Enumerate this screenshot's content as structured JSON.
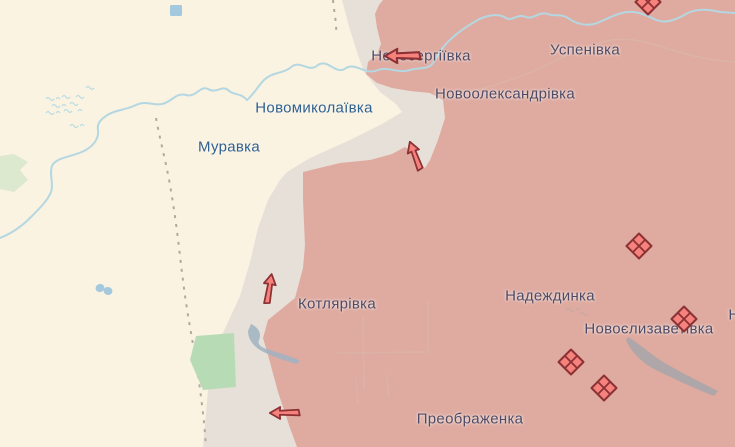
{
  "map": {
    "colors": {
      "free_area": "#faf3e2",
      "grey_zone": "#e7e0d8",
      "occupied_area": "#dfaaa0",
      "river": "#b4d7e1",
      "marsh": "#b9dbe4",
      "marsh_grey": "#b6a9a4",
      "lake_grey": "#a7a6aa",
      "pond_blue": "#a4c8de",
      "forest_green": "#b7dcb5",
      "field_green": "#dce9cf",
      "road": "#d9bcab",
      "border_dash": "#b3a89f",
      "marker_fill": "#f6827d",
      "marker_stroke": "#8c3134",
      "label_free": "#30618f",
      "label_occupied": "#4e4a66"
    },
    "settlements": [
      {
        "name": "Новосергіївка",
        "x": 421,
        "y": 56,
        "zone": "occupied"
      },
      {
        "name": "Успенівка",
        "x": 585,
        "y": 50,
        "zone": "occupied"
      },
      {
        "name": "Новоолександрівка",
        "x": 505,
        "y": 94,
        "zone": "occupied"
      },
      {
        "name": "Новомиколаївка",
        "x": 314,
        "y": 108,
        "zone": "free"
      },
      {
        "name": "Муравка",
        "x": 229,
        "y": 147,
        "zone": "free"
      },
      {
        "name": "Котлярівка",
        "x": 337,
        "y": 304,
        "zone": "occupied"
      },
      {
        "name": "Надеждинка",
        "x": 550,
        "y": 296,
        "zone": "occupied"
      },
      {
        "name": "Новоєлизаветівка",
        "x": 649,
        "y": 329,
        "zone": "occupied"
      },
      {
        "name": "Преображенка",
        "x": 470,
        "y": 419,
        "zone": "occupied"
      },
      {
        "name": "Н",
        "x": 734,
        "y": 315,
        "zone": "occupied"
      }
    ],
    "attack_arrows": [
      {
        "x": 403,
        "y": 56,
        "rotation": 0,
        "scale": 0.95
      },
      {
        "x": 415,
        "y": 156,
        "rotation": 70,
        "scale": 0.8
      },
      {
        "x": 269,
        "y": 289,
        "rotation": 100,
        "scale": 0.8
      },
      {
        "x": 285,
        "y": 413,
        "rotation": 0,
        "scale": 0.8
      }
    ],
    "unit_markers": [
      {
        "x": 648,
        "y": 2
      },
      {
        "x": 639,
        "y": 246
      },
      {
        "x": 684,
        "y": 319
      },
      {
        "x": 571,
        "y": 362
      },
      {
        "x": 604,
        "y": 388
      }
    ]
  }
}
